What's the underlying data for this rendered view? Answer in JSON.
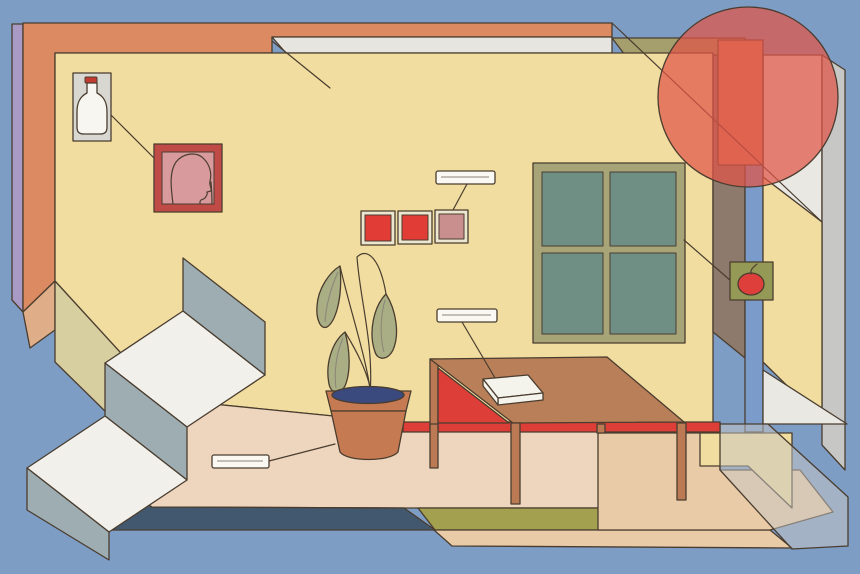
{
  "scene": {
    "type": "flat-illustration",
    "setting": "stylized living-room interior: staircase, window, potted plant, table with book, wall art, labelled objects",
    "blank_labels": [
      {
        "id": "squares-label",
        "text": "",
        "points_to": "wall-squares"
      },
      {
        "id": "book-label",
        "text": "",
        "points_to": "book-on-table"
      },
      {
        "id": "floor-label",
        "text": "",
        "points_to": "plant-pot"
      }
    ],
    "objects": [
      "milk-bottle-card",
      "portrait-frame",
      "wall-squares",
      "window",
      "tomato-card",
      "red-circle",
      "staircase",
      "potted-plant",
      "table",
      "book",
      "floor"
    ]
  },
  "palette": {
    "background": "#7e9dc5",
    "purple": "#a89ac4",
    "orange": "#db8a61",
    "wall": "#f1dd9f",
    "cornice": "#e6e5df",
    "olive": "#a59f6d",
    "windowFrame": "#a7a478",
    "windowPane": "#6f8e84",
    "circle": "#e05448",
    "cardGray": "#d8d7d1",
    "bottle": "#f7f6f1",
    "cap": "#c23b30",
    "frameRed": "#c04a45",
    "framePink": "#d89a9d",
    "squareRed": "#e23c36",
    "squareMuted": "#c98f8f",
    "squareBorder": "#ece5cf",
    "tomatoCard": "#949a55",
    "tomato": "#df3f3b",
    "brownStrip": "#8d7a6c",
    "blueStrip": "#7b9bca",
    "grayStrip": "#c7c7c5",
    "whitePlane": "#e9e8e3",
    "tableTop": "#b97f58",
    "tableRed": "#dd3f38",
    "tableLeg": "#bc7a54",
    "book": "#f4f3ec",
    "floor": "#eed5be",
    "floorDark": "#41586e",
    "floorOlive": "#a3a04f",
    "floorPeach": "#e9cba7",
    "tread": "#f1f0ea",
    "riser": "#9dadb2",
    "pot": "#c67a52",
    "soil": "#3b4a7e",
    "leaf": "#a9ae84",
    "label": "#f9f8f3",
    "outline": "#4a3d2f",
    "khaki": "#d8cfa0",
    "tan": "#dfae88"
  }
}
